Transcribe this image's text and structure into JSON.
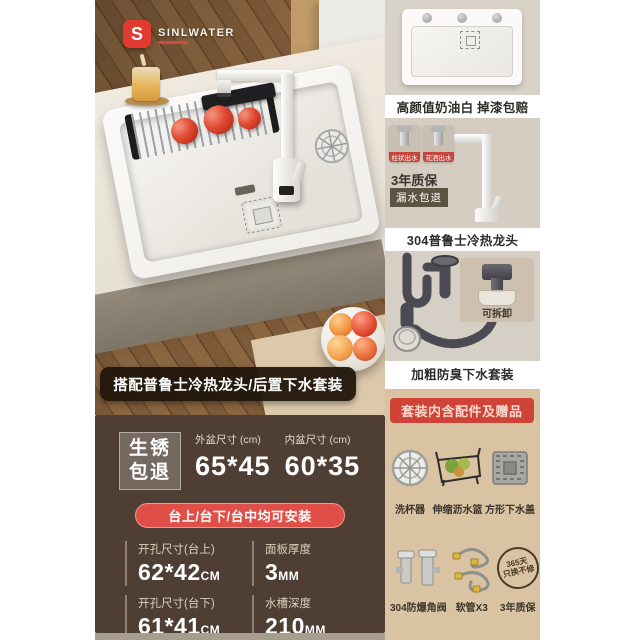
{
  "brand": {
    "initial": "S",
    "name": "SINLWATER"
  },
  "colors": {
    "accent_red": "#cf4238",
    "pill_red": "#e04f47",
    "spec_panel_brown": "#4e3e33",
    "banner_dark": "#21160c",
    "panel_beige": "#d6cec4",
    "panel_tan": "#d9c3a3"
  },
  "photo": {
    "banner": "搭配普鲁士冷热龙头/后置下水套装"
  },
  "specs": {
    "rust_line1": "生锈",
    "rust_line2": "包退",
    "outer_label": "外盆尺寸 (cm)",
    "outer_value": "65*45",
    "inner_label": "内盆尺寸 (cm)",
    "inner_value": "60*35",
    "install_note": "台上/台下/台中均可安装",
    "details": [
      {
        "label": "开孔尺寸(台上)",
        "value": "62*42",
        "unit": "CM"
      },
      {
        "label": "面板厚度",
        "value": "3",
        "unit": "MM"
      },
      {
        "label": "开孔尺寸(台下)",
        "value": "61*41",
        "unit": "CM"
      },
      {
        "label": "水槽深度",
        "value": "210",
        "unit": "MM"
      }
    ]
  },
  "panels": {
    "cream": {
      "caption": "高颜值奶油白 掉漆包赔"
    },
    "faucet": {
      "caption": "304普鲁士冷热龙头",
      "mode1": "柱状出水",
      "mode2": "花洒出水",
      "warranty": "3年质保",
      "refund": "漏水包退"
    },
    "drain": {
      "caption": "加粗防臭下水套装",
      "detach": "可拆卸"
    },
    "kit": {
      "header": "套装内含配件及赠品",
      "row1": [
        {
          "label": "洗杯器"
        },
        {
          "label": "伸缩沥水篮"
        },
        {
          "label": "方形下水盖"
        }
      ],
      "row2": [
        {
          "label": "304防爆角阀"
        },
        {
          "label": "软管X3"
        },
        {
          "label": "3年质保"
        }
      ],
      "stamp_line1": "365天",
      "stamp_line2": "只换不修"
    }
  }
}
